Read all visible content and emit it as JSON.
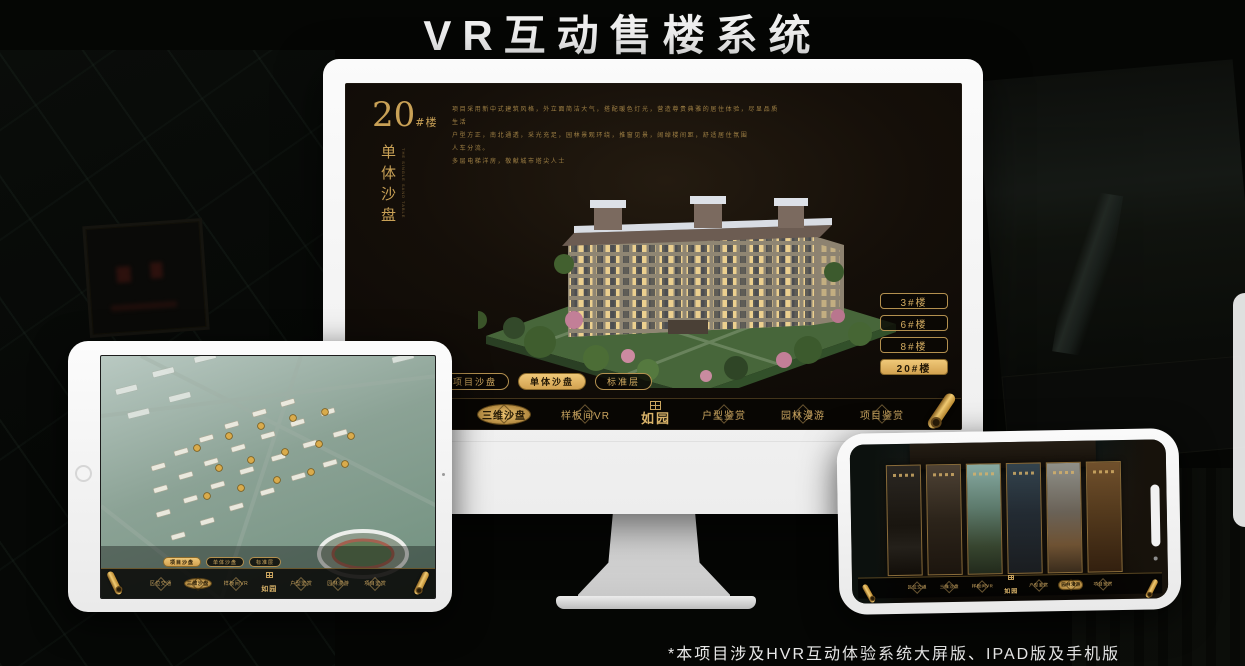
{
  "page": {
    "title": "VR互动售楼系统",
    "footnote": "*本项目涉及HVR互动体验系统大屏版、IPAD版及手机版"
  },
  "colors": {
    "gold": "#cda55e",
    "gold_active": "#eec573",
    "screen_bg": "#150f09",
    "nav_bg": "#080603",
    "headline_text": "#f0f0f0"
  },
  "logo": {
    "name": "如园",
    "icon": "seal-icon"
  },
  "monitor": {
    "building_no": "20",
    "building_no_suffix": "#楼",
    "section_title": "单体沙盘",
    "section_title_en": "THE SINGLE SAND TABLE",
    "description_lines": [
      "项目采用新中式建筑风格，外立面简洁大气，搭配暖色灯光，营造尊贵典雅的居住体验，尽显品质生活",
      "户型方正，南北通透，采光充足，园林景观环绕，推窗见景，阔绰楼间距，舒适居住氛围",
      "人车分流。",
      "多层电梯洋房，敬献城市塔尖人士"
    ],
    "tower_buttons": [
      {
        "label": "3#楼",
        "active": false
      },
      {
        "label": "6#楼",
        "active": false
      },
      {
        "label": "8#楼",
        "active": false
      },
      {
        "label": "20#楼",
        "active": true
      }
    ],
    "tabs": [
      {
        "label": "项目沙盘",
        "active": false
      },
      {
        "label": "单体沙盘",
        "active": true
      },
      {
        "label": "标准层",
        "active": false
      }
    ],
    "nav": {
      "logo": "如园",
      "items": [
        {
          "label": "区位交通",
          "active": false
        },
        {
          "label": "三维沙盘",
          "active": true
        },
        {
          "label": "样板间VR",
          "active": false
        },
        {
          "label": "户型鉴赏",
          "active": false
        },
        {
          "label": "园林漫游",
          "active": false
        },
        {
          "label": "项目鉴赏",
          "active": false
        }
      ]
    }
  },
  "tablet": {
    "tabs": [
      {
        "label": "项目沙盘",
        "active": true
      },
      {
        "label": "单体沙盘",
        "active": false
      },
      {
        "label": "标准层",
        "active": false
      }
    ],
    "nav": {
      "logo": "如园",
      "items": [
        {
          "label": "区位交通",
          "active": false
        },
        {
          "label": "三维沙盘",
          "active": true
        },
        {
          "label": "样板间VR",
          "active": false
        },
        {
          "label": "户型鉴赏",
          "active": false
        },
        {
          "label": "园林漫游",
          "active": false
        },
        {
          "label": "项目鉴赏",
          "active": false
        }
      ]
    }
  },
  "phone": {
    "nav": {
      "logo": "如园",
      "items": [
        {
          "label": "区位交通",
          "active": false
        },
        {
          "label": "三维沙盘",
          "active": false
        },
        {
          "label": "样板间VR",
          "active": false
        },
        {
          "label": "户型鉴赏",
          "active": false
        },
        {
          "label": "园林漫游",
          "active": true
        },
        {
          "label": "项目鉴赏",
          "active": false
        }
      ]
    }
  }
}
